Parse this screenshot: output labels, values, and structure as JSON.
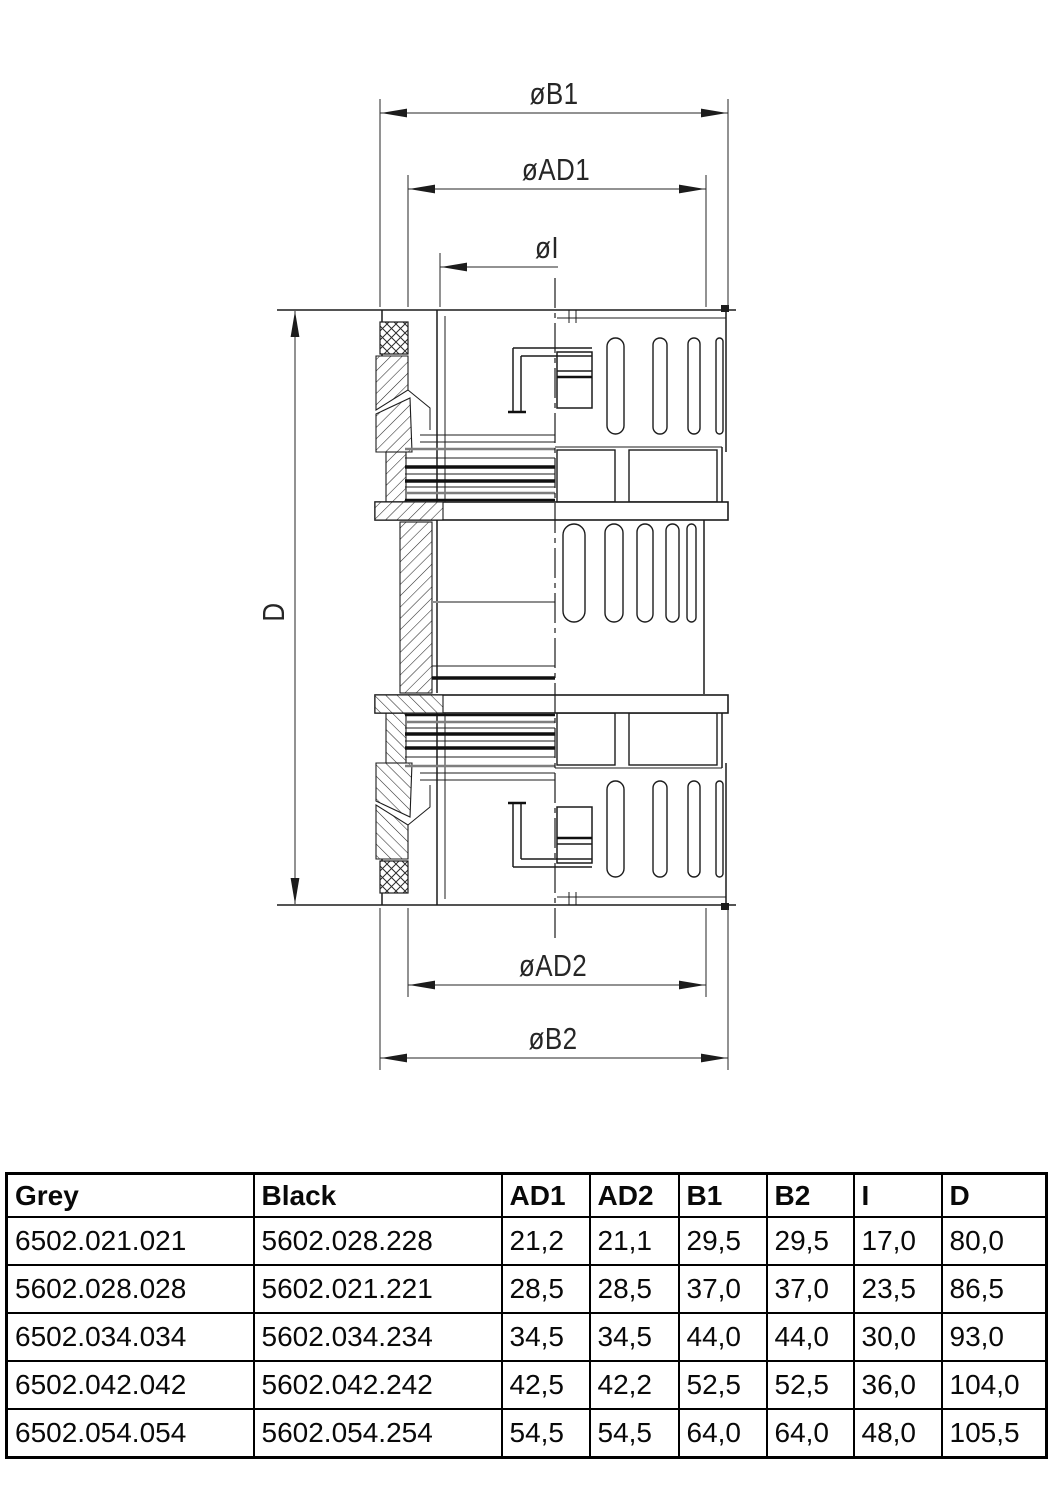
{
  "drawing": {
    "labels": {
      "b1": "øB1",
      "ad1": "øAD1",
      "i": "øI",
      "d": "D",
      "ad2": "øAD2",
      "b2": "øB2"
    }
  },
  "table": {
    "headers": [
      "Grey",
      "Black",
      "AD1",
      "AD2",
      "B1",
      "B2",
      "I",
      "D"
    ],
    "rows": [
      [
        "6502.021.021",
        "5602.028.228",
        "21,2",
        "21,1",
        "29,5",
        "29,5",
        "17,0",
        "80,0"
      ],
      [
        "5602.028.028",
        "5602.021.221",
        "28,5",
        "28,5",
        "37,0",
        "37,0",
        "23,5",
        "86,5"
      ],
      [
        "6502.034.034",
        "5602.034.234",
        "34,5",
        "34,5",
        "44,0",
        "44,0",
        "30,0",
        "93,0"
      ],
      [
        "6502.042.042",
        "5602.042.242",
        "42,5",
        "42,2",
        "52,5",
        "52,5",
        "36,0",
        "104,0"
      ],
      [
        "6502.054.054",
        "5602.054.254",
        "54,5",
        "54,5",
        "64,0",
        "64,0",
        "48,0",
        "105,5"
      ]
    ]
  },
  "colors": {
    "ink": "#1c1c1c",
    "gray_line": "#7e7e7e",
    "background": "#ffffff"
  }
}
